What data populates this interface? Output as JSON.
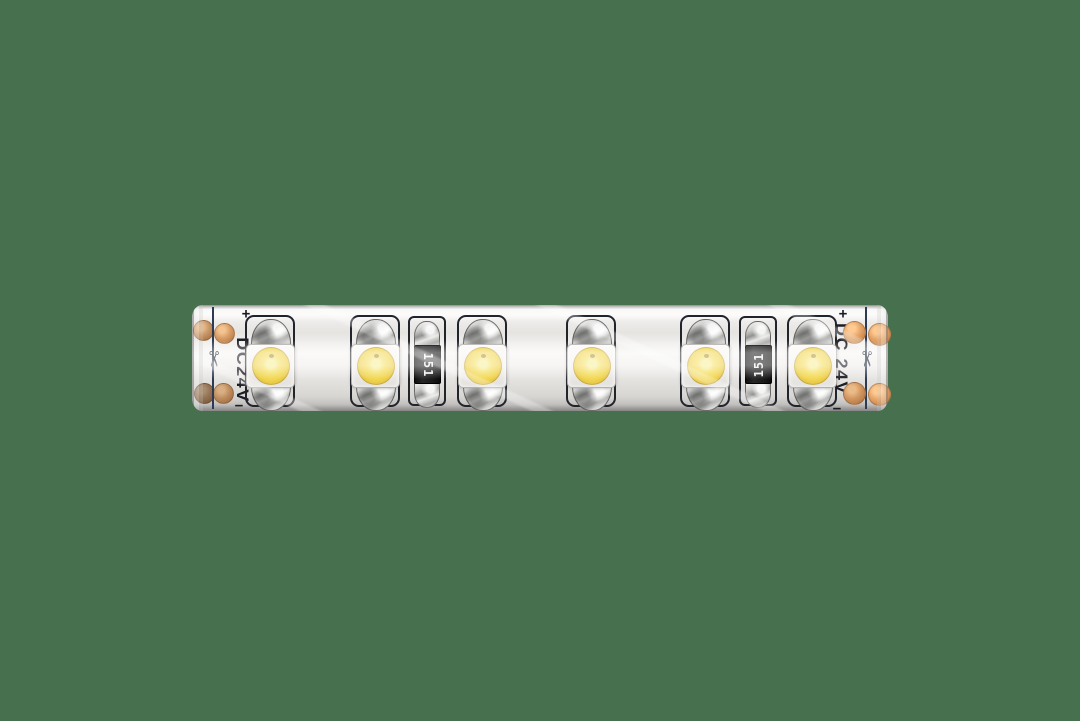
{
  "scene": {
    "description": "Product photo of a white flexible waterproof LED strip segment lying horizontally on a plain green background",
    "background_color": "#47714e"
  },
  "strip": {
    "markings": {
      "left_voltage": "DC24V",
      "right_voltage": "DC 24V",
      "plus": "+",
      "minus": "−",
      "resistor_code": "151"
    },
    "led_count": 6,
    "resistor_count": 2,
    "colors": {
      "strip_body": "#edebe8",
      "led_phosphor": "#f1d54f",
      "led_package": "#f6f4f1",
      "solder_pad_silver": "#c9c9c7",
      "copper_pad": "#c08a5c",
      "resistor_body": "#1a1a1a",
      "silkscreen_outline": "#20242b",
      "cut_line": "#2c3a52"
    },
    "components": [
      {
        "type": "copper-pads",
        "side": "left",
        "dots": [
          [
            10,
            24
          ],
          [
            31,
            27
          ],
          [
            11,
            87
          ],
          [
            30,
            87
          ]
        ],
        "diameter": 19
      },
      {
        "type": "cut-mark",
        "x": 21
      },
      {
        "type": "voltage-label",
        "x": 50,
        "cy": 65,
        "text_key": "left_voltage",
        "plus": [
          54,
          9
        ],
        "minus": [
          47,
          101
        ]
      },
      {
        "type": "led",
        "x": 78
      },
      {
        "type": "led",
        "x": 183
      },
      {
        "type": "resistor",
        "x": 235,
        "label": "151",
        "label_rotation": 90
      },
      {
        "type": "led",
        "x": 290
      },
      {
        "type": "led",
        "x": 399
      },
      {
        "type": "led",
        "x": 513
      },
      {
        "type": "resistor",
        "x": 566,
        "label": "151",
        "label_rotation": -90
      },
      {
        "type": "led",
        "x": 620
      },
      {
        "type": "voltage-label",
        "x": 649,
        "cy": 54,
        "text_key": "right_voltage",
        "plus": [
          651,
          9
        ],
        "minus": [
          645,
          104
        ]
      },
      {
        "type": "cut-mark",
        "x": 674
      },
      {
        "type": "copper-pads",
        "side": "right",
        "dots": [
          [
            661,
            26
          ],
          [
            686,
            28
          ],
          [
            661,
            87
          ],
          [
            686,
            88
          ]
        ],
        "diameter": 21
      }
    ]
  }
}
